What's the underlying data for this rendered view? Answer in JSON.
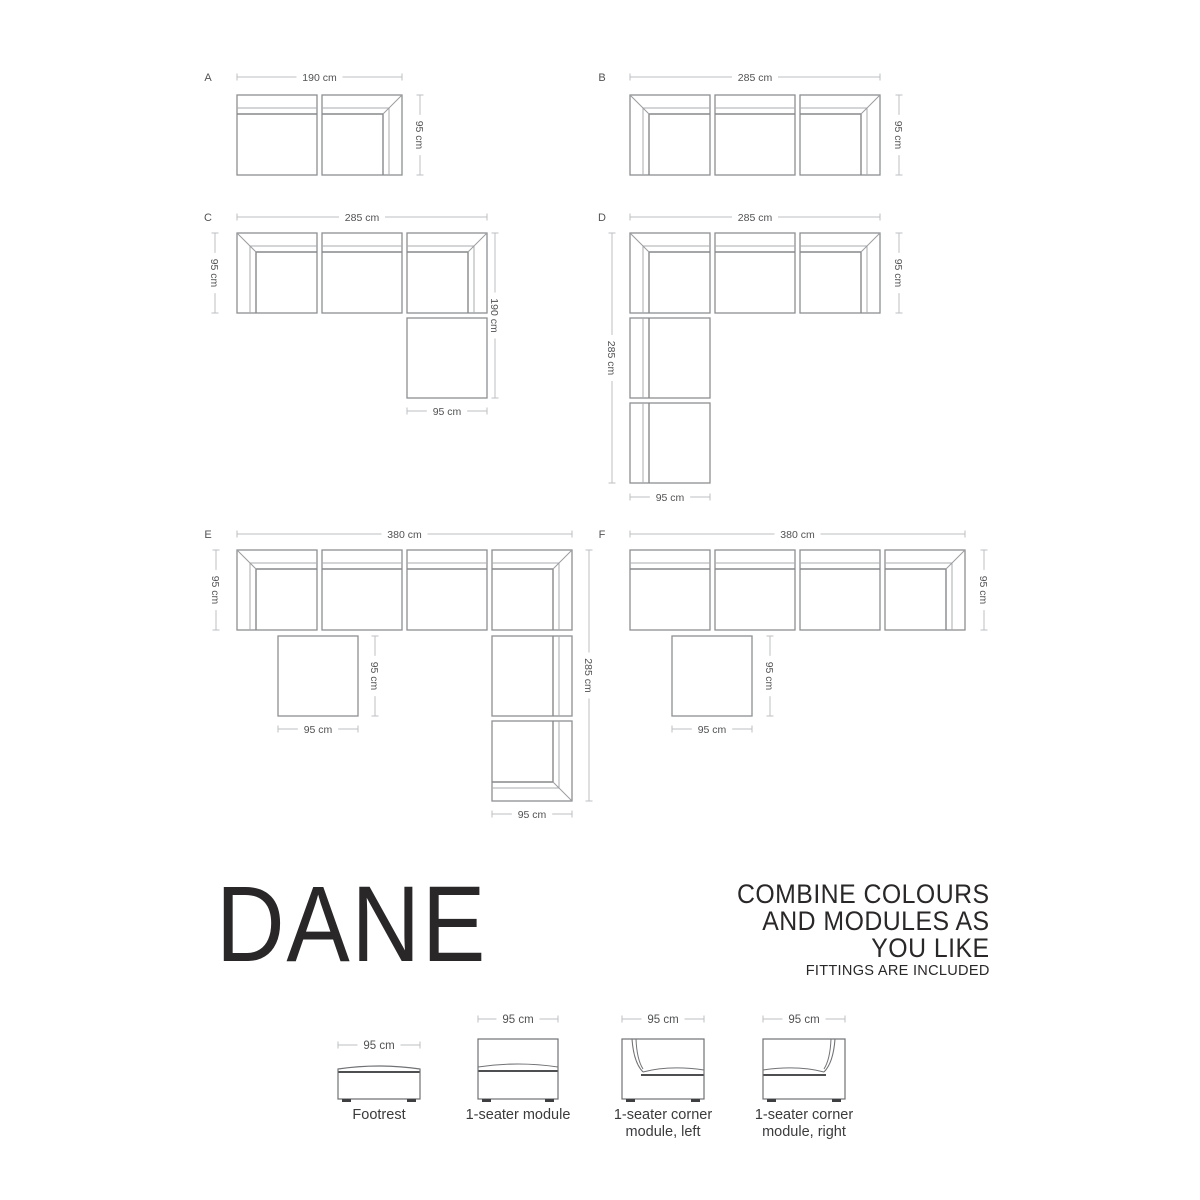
{
  "branding": {
    "title": "DANE",
    "headline_lines": [
      "COMBINE COLOURS",
      "AND MODULES AS",
      "YOU LIKE"
    ],
    "subheadline": "FITTINGS ARE INCLUDED"
  },
  "colors": {
    "background": "#ffffff",
    "module_outline": "#8d8f92",
    "module_line_light": "#a9abae",
    "module_line_dark": "#87898c",
    "module_diagonal": "#9b9da0",
    "dim_line": "#bdbfc1",
    "dim_text": "#515254",
    "icon_outline": "#707275",
    "icon_seat_dark": "#4e4f51",
    "icon_feet": "#3e3f41",
    "text_dark": "#2a2728",
    "label_text": "#3b3b3d"
  },
  "configurations": [
    {
      "letter": "A",
      "letter_pos": [
        208,
        77
      ],
      "modules": [
        {
          "type": "plain-top",
          "x": 237,
          "y": 95
        },
        {
          "type": "corner-tr",
          "x": 322,
          "y": 95
        }
      ],
      "dims": [
        {
          "dir": "h",
          "x1": 237,
          "x2": 402,
          "y": 77,
          "label": "190 cm"
        },
        {
          "dir": "v",
          "x": 420,
          "y1": 95,
          "y2": 175,
          "label": "95 cm"
        }
      ]
    },
    {
      "letter": "B",
      "letter_pos": [
        602,
        77
      ],
      "modules": [
        {
          "type": "corner-tl",
          "x": 630,
          "y": 95
        },
        {
          "type": "plain-top",
          "x": 715,
          "y": 95
        },
        {
          "type": "corner-tr",
          "x": 800,
          "y": 95
        }
      ],
      "dims": [
        {
          "dir": "h",
          "x1": 630,
          "x2": 880,
          "y": 77,
          "label": "285 cm"
        },
        {
          "dir": "v",
          "x": 899,
          "y1": 95,
          "y2": 175,
          "label": "95 cm"
        }
      ]
    },
    {
      "letter": "C",
      "letter_pos": [
        208,
        217
      ],
      "modules": [
        {
          "type": "corner-tl",
          "x": 237,
          "y": 233
        },
        {
          "type": "plain-top",
          "x": 322,
          "y": 233
        },
        {
          "type": "corner-tr",
          "x": 407,
          "y": 233
        },
        {
          "type": "footrest",
          "x": 407,
          "y": 318
        }
      ],
      "dims": [
        {
          "dir": "h",
          "x1": 237,
          "x2": 487,
          "y": 217,
          "label": "285 cm"
        },
        {
          "dir": "v",
          "x": 215,
          "y1": 233,
          "y2": 313,
          "label": "95 cm"
        },
        {
          "dir": "v",
          "x": 495,
          "y1": 233,
          "y2": 398,
          "label": "190 cm"
        },
        {
          "dir": "h",
          "x1": 407,
          "x2": 487,
          "y": 411,
          "label": "95 cm"
        }
      ]
    },
    {
      "letter": "D",
      "letter_pos": [
        602,
        217
      ],
      "modules": [
        {
          "type": "corner-tl",
          "x": 630,
          "y": 233
        },
        {
          "type": "plain-top",
          "x": 715,
          "y": 233
        },
        {
          "type": "corner-tr",
          "x": 800,
          "y": 233
        },
        {
          "type": "plain-left",
          "x": 630,
          "y": 318
        },
        {
          "type": "plain-left",
          "x": 630,
          "y": 403
        }
      ],
      "dims": [
        {
          "dir": "h",
          "x1": 630,
          "x2": 880,
          "y": 217,
          "label": "285 cm"
        },
        {
          "dir": "v",
          "x": 899,
          "y1": 233,
          "y2": 313,
          "label": "95 cm"
        },
        {
          "dir": "v",
          "x": 612,
          "y1": 233,
          "y2": 483,
          "label": "285 cm"
        },
        {
          "dir": "h",
          "x1": 630,
          "x2": 710,
          "y": 497,
          "label": "95 cm"
        }
      ]
    },
    {
      "letter": "E",
      "letter_pos": [
        208,
        534
      ],
      "modules": [
        {
          "type": "corner-tl",
          "x": 237,
          "y": 550
        },
        {
          "type": "plain-top",
          "x": 322,
          "y": 550
        },
        {
          "type": "plain-top",
          "x": 407,
          "y": 550
        },
        {
          "type": "corner-tr",
          "x": 492,
          "y": 550
        },
        {
          "type": "footrest",
          "x": 278,
          "y": 636
        },
        {
          "type": "plain-right",
          "x": 492,
          "y": 636
        },
        {
          "type": "corner-br",
          "x": 492,
          "y": 721
        }
      ],
      "dims": [
        {
          "dir": "h",
          "x1": 237,
          "x2": 572,
          "y": 534,
          "label": "380 cm"
        },
        {
          "dir": "v",
          "x": 216,
          "y1": 550,
          "y2": 630,
          "label": "95 cm"
        },
        {
          "dir": "v",
          "x": 375,
          "y1": 636,
          "y2": 716,
          "label": "95 cm"
        },
        {
          "dir": "h",
          "x1": 278,
          "x2": 358,
          "y": 729,
          "label": "95 cm"
        },
        {
          "dir": "v",
          "x": 589,
          "y1": 550,
          "y2": 801,
          "label": "285 cm"
        },
        {
          "dir": "h",
          "x1": 492,
          "x2": 572,
          "y": 814,
          "label": "95 cm"
        }
      ]
    },
    {
      "letter": "F",
      "letter_pos": [
        602,
        534
      ],
      "modules": [
        {
          "type": "plain-top",
          "x": 630,
          "y": 550
        },
        {
          "type": "plain-top",
          "x": 715,
          "y": 550
        },
        {
          "type": "plain-top",
          "x": 800,
          "y": 550
        },
        {
          "type": "corner-tr",
          "x": 885,
          "y": 550
        },
        {
          "type": "footrest",
          "x": 672,
          "y": 636
        }
      ],
      "dims": [
        {
          "dir": "h",
          "x1": 630,
          "x2": 965,
          "y": 534,
          "label": "380 cm"
        },
        {
          "dir": "v",
          "x": 984,
          "y1": 550,
          "y2": 630,
          "label": "95 cm"
        },
        {
          "dir": "v",
          "x": 770,
          "y1": 636,
          "y2": 716,
          "label": "95 cm"
        },
        {
          "dir": "h",
          "x1": 672,
          "x2": 752,
          "y": 729,
          "label": "95 cm"
        }
      ]
    }
  ],
  "legend": {
    "items": [
      {
        "icon": "footrest-front",
        "box": [
          338,
          1065,
          82,
          34
        ],
        "dim": {
          "x1": 338,
          "x2": 420,
          "y": 1045,
          "label": "95 cm"
        },
        "lines": [
          "Footrest",
          ""
        ]
      },
      {
        "icon": "seat-front",
        "box": [
          478,
          1039,
          80,
          60
        ],
        "dim": {
          "x1": 478,
          "x2": 558,
          "y": 1019,
          "label": "95 cm"
        },
        "lines": [
          "1-seater module",
          ""
        ]
      },
      {
        "icon": "corner-left-front",
        "box": [
          622,
          1039,
          82,
          60
        ],
        "dim": {
          "x1": 622,
          "x2": 704,
          "y": 1019,
          "label": "95 cm"
        },
        "lines": [
          "1-seater corner",
          "module, left"
        ]
      },
      {
        "icon": "corner-right-front",
        "box": [
          763,
          1039,
          82,
          60
        ],
        "dim": {
          "x1": 763,
          "x2": 845,
          "y": 1019,
          "label": "95 cm"
        },
        "lines": [
          "1-seater corner",
          "module, right"
        ]
      }
    ]
  }
}
